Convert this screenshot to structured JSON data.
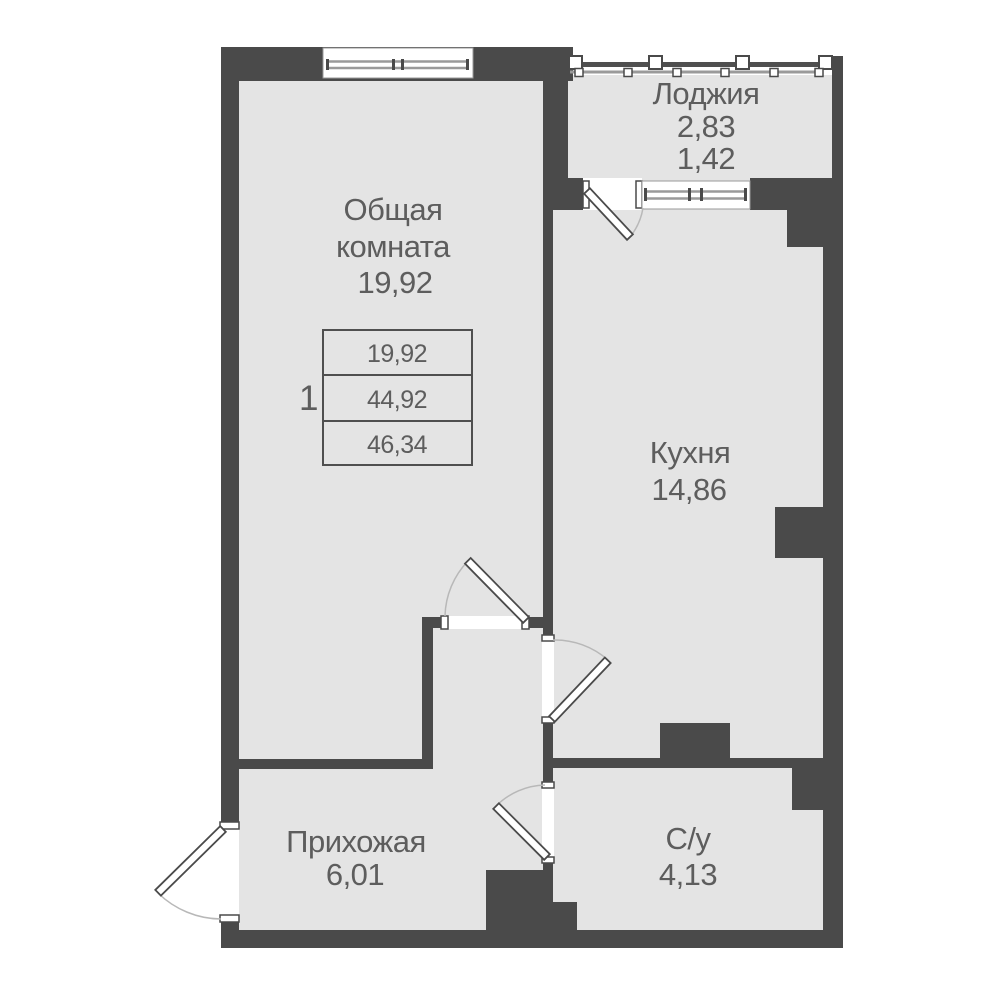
{
  "plan": {
    "rooms": [
      {
        "id": "loggia",
        "label": "Лоджия",
        "area": "2,83",
        "area_secondary": "1,42"
      },
      {
        "id": "living_room",
        "label_line1": "Общая",
        "label_line2": "комната",
        "area": "19,92"
      },
      {
        "id": "kitchen",
        "label": "Кухня",
        "area": "14,86"
      },
      {
        "id": "hallway",
        "label": "Прихожая",
        "area": "6,01"
      },
      {
        "id": "bathroom",
        "label": "С/у",
        "area": "4,13"
      }
    ],
    "summary": {
      "rooms_count": "1",
      "values": [
        "19,92",
        "44,92",
        "46,34"
      ]
    },
    "colors": {
      "wall": "#4a4a4a",
      "floor": "#e4e4e4",
      "text": "#5d5d5d"
    }
  }
}
